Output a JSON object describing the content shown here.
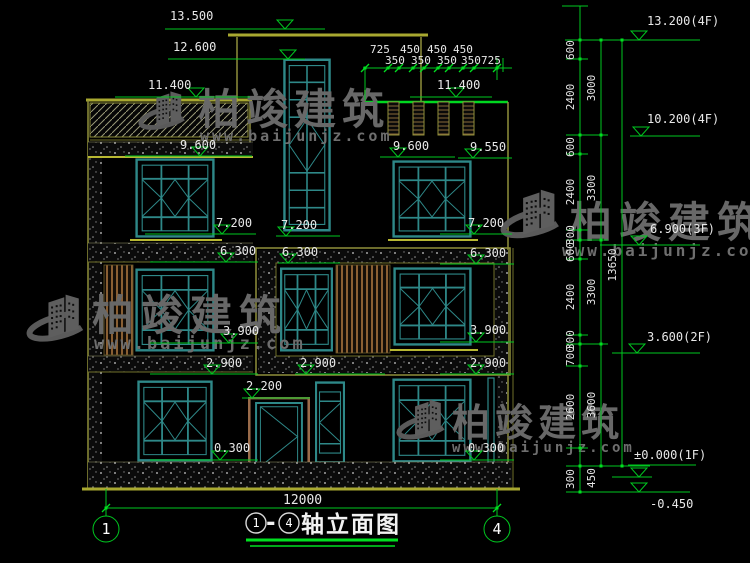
{
  "watermark": {
    "brand": "柏竣建筑",
    "url": "www.baijunjz.com"
  },
  "levels": {
    "v13500": "13.500",
    "v12600": "12.600",
    "v11400L": "11.400",
    "v11400R": "11.400",
    "v9600L": "9.600",
    "v9600R": "9.600",
    "v9550": "9.550",
    "v7200L": "7.200",
    "v7200C": "7.200",
    "v7200R": "7.200",
    "v6300L": "6.300",
    "v6300C": "6.300",
    "v6300R": "6.300",
    "v3900L": "3.900",
    "v3900R": "3.900",
    "v2900L": "2.900",
    "v2900C": "2.900",
    "v2900R": "2.900",
    "v2200": "2.200",
    "v0300L": "0.300",
    "v0300R": "0.300"
  },
  "right_levels": {
    "r13200": "13.200(4F)",
    "r10200": "10.200(4F)",
    "r6900": "6.900(3F)",
    "r3600": "3.600(2F)",
    "r0000": "±0.000(1F)",
    "rneg450": "-0.450"
  },
  "top_dims": {
    "row1": [
      "725",
      "450",
      "450",
      "450"
    ],
    "row2": [
      "350",
      "350",
      "350",
      "350",
      "725"
    ]
  },
  "right_dims": {
    "col1": [
      "600",
      "2400",
      "600",
      "2400",
      "300",
      "600",
      "2400",
      "300",
      "700",
      "2600",
      "300"
    ],
    "col2": [
      "3000",
      "3300",
      "3300",
      "3600",
      "450"
    ],
    "total": "13650"
  },
  "bottom_dims": {
    "total_width": "12000"
  },
  "axes": {
    "left": "1",
    "right": "4"
  },
  "title": {
    "axis_from": "1",
    "dash": "-",
    "axis_to": "4",
    "name": "轴立面图"
  }
}
